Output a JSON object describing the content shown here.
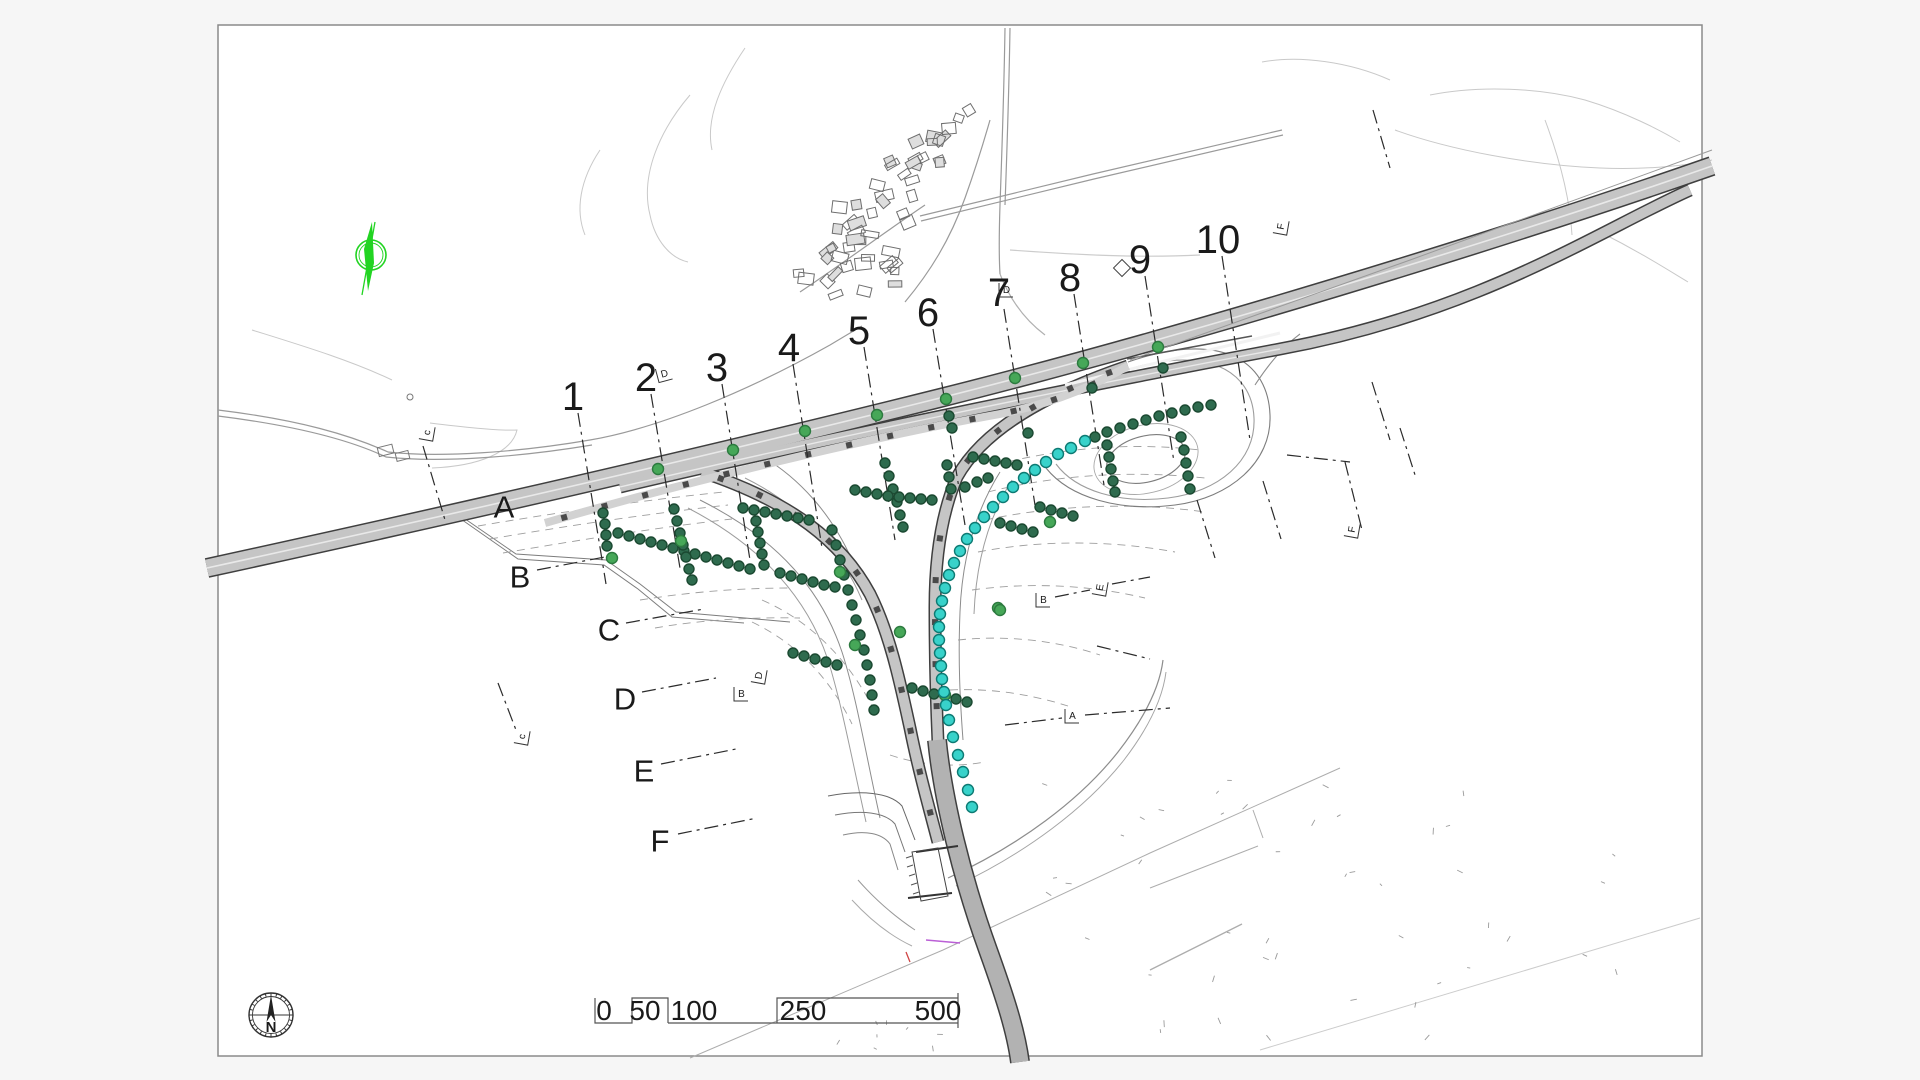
{
  "palette": {
    "background": "#f6f6f6",
    "paper": "#ffffff",
    "sheet_border": "#8a8a8a",
    "road_fill": "#c5c5c5",
    "road_fill_dark": "#b2b2b2",
    "road_casing": "#3f3f3f",
    "grid_line": "#2b2b2b",
    "dark_point_fill": "#2e6b4e",
    "dark_point_stroke": "#1b4931",
    "green_point_fill": "#46a758",
    "green_point_stroke": "#2c7a3f",
    "cyan_point_fill": "#38d2ca",
    "cyan_point_stroke": "#0d7a73",
    "north_symbol_green": "#22d422"
  },
  "compass": {
    "label": "N"
  },
  "scale_bar": {
    "labels": [
      "0",
      "50",
      "100",
      "250",
      "500"
    ]
  },
  "grid": {
    "columns": [
      {
        "label": "1",
        "lx": 573,
        "ly": 397,
        "x1": 578,
        "y1": 413,
        "x2": 606,
        "y2": 584
      },
      {
        "label": "2",
        "lx": 646,
        "ly": 378,
        "x1": 651,
        "y1": 394,
        "x2": 680,
        "y2": 568
      },
      {
        "label": "3",
        "lx": 717,
        "ly": 368,
        "x1": 722,
        "y1": 384,
        "x2": 750,
        "y2": 560
      },
      {
        "label": "4",
        "lx": 789,
        "ly": 348,
        "x1": 793,
        "y1": 364,
        "x2": 822,
        "y2": 548
      },
      {
        "label": "5",
        "lx": 859,
        "ly": 331,
        "x1": 864,
        "y1": 347,
        "x2": 895,
        "y2": 540
      },
      {
        "label": "6",
        "lx": 928,
        "ly": 313,
        "x1": 933,
        "y1": 329,
        "x2": 965,
        "y2": 525
      },
      {
        "label": "7",
        "lx": 999,
        "ly": 293,
        "x1": 1004,
        "y1": 309,
        "x2": 1035,
        "y2": 505
      },
      {
        "label": "8",
        "lx": 1070,
        "ly": 278,
        "x1": 1074,
        "y1": 294,
        "x2": 1104,
        "y2": 485
      },
      {
        "label": "9",
        "lx": 1140,
        "ly": 260,
        "x1": 1145,
        "y1": 276,
        "x2": 1174,
        "y2": 462
      },
      {
        "label": "10",
        "lx": 1218,
        "ly": 240,
        "x1": 1222,
        "y1": 256,
        "x2": 1250,
        "y2": 440
      }
    ],
    "rows": [
      {
        "label": "A",
        "lx": 504,
        "ly": 507
      },
      {
        "label": "B",
        "lx": 520,
        "ly": 577,
        "x1": 537,
        "y1": 570,
        "x2": 610,
        "y2": 556
      },
      {
        "label": "C",
        "lx": 609,
        "ly": 630,
        "x1": 626,
        "y1": 623,
        "x2": 704,
        "y2": 609
      },
      {
        "label": "D",
        "lx": 625,
        "ly": 699,
        "x1": 642,
        "y1": 692,
        "x2": 716,
        "y2": 678
      },
      {
        "label": "E",
        "lx": 644,
        "ly": 771,
        "x1": 661,
        "y1": 764,
        "x2": 736,
        "y2": 749
      },
      {
        "label": "F",
        "lx": 660,
        "ly": 841,
        "x1": 678,
        "y1": 834,
        "x2": 757,
        "y2": 818
      }
    ],
    "extra_segments": [
      [
        1197,
        500,
        1215,
        558
      ],
      [
        1263,
        481,
        1281,
        539
      ],
      [
        1287,
        455,
        1350,
        462
      ],
      [
        1345,
        462,
        1362,
        530
      ],
      [
        1055,
        597,
        1090,
        590
      ],
      [
        1112,
        584,
        1150,
        577
      ],
      [
        1005,
        725,
        1062,
        718
      ],
      [
        1085,
        715,
        1170,
        708
      ],
      [
        1097,
        646,
        1150,
        659
      ],
      [
        1372,
        382,
        1390,
        440
      ],
      [
        1400,
        428,
        1416,
        478
      ],
      [
        1373,
        110,
        1390,
        168
      ],
      [
        423,
        446,
        445,
        520
      ],
      [
        498,
        683,
        516,
        730
      ]
    ]
  },
  "section_flags": [
    {
      "x": 664,
      "y": 374,
      "t": "D",
      "r": -15
    },
    {
      "x": 427,
      "y": 433,
      "t": "c",
      "r": -80
    },
    {
      "x": 522,
      "y": 737,
      "t": "c",
      "r": -80
    },
    {
      "x": 759,
      "y": 676,
      "t": "D",
      "r": -80
    },
    {
      "x": 741,
      "y": 694,
      "t": "B",
      "r": 0
    },
    {
      "x": 1043,
      "y": 600,
      "t": "B",
      "r": 0
    },
    {
      "x": 1100,
      "y": 588,
      "t": "E",
      "r": -80
    },
    {
      "x": 1352,
      "y": 530,
      "t": "F",
      "r": -80
    },
    {
      "x": 1072,
      "y": 716,
      "t": "A",
      "r": 0
    },
    {
      "x": 1281,
      "y": 227,
      "t": "F",
      "r": -80
    },
    {
      "x": 1006,
      "y": 290,
      "t": "D",
      "r": 0
    }
  ],
  "diamond_marker": {
    "x": 1122,
    "y": 268
  },
  "points": {
    "dark": [
      [
        603,
        513
      ],
      [
        605,
        524
      ],
      [
        606,
        535
      ],
      [
        607,
        546
      ],
      [
        618,
        533
      ],
      [
        629,
        536
      ],
      [
        640,
        539
      ],
      [
        651,
        542
      ],
      [
        662,
        545
      ],
      [
        673,
        548
      ],
      [
        684,
        551
      ],
      [
        695,
        554
      ],
      [
        674,
        509
      ],
      [
        677,
        521
      ],
      [
        680,
        533
      ],
      [
        683,
        545
      ],
      [
        686,
        557
      ],
      [
        689,
        569
      ],
      [
        692,
        580
      ],
      [
        706,
        557
      ],
      [
        717,
        560
      ],
      [
        728,
        563
      ],
      [
        739,
        566
      ],
      [
        750,
        569
      ],
      [
        743,
        508
      ],
      [
        754,
        510
      ],
      [
        765,
        512
      ],
      [
        776,
        514
      ],
      [
        787,
        516
      ],
      [
        798,
        518
      ],
      [
        809,
        520
      ],
      [
        756,
        521
      ],
      [
        758,
        532
      ],
      [
        760,
        543
      ],
      [
        762,
        554
      ],
      [
        764,
        565
      ],
      [
        780,
        573
      ],
      [
        791,
        576
      ],
      [
        802,
        579
      ],
      [
        813,
        582
      ],
      [
        824,
        585
      ],
      [
        835,
        587
      ],
      [
        832,
        530
      ],
      [
        836,
        545
      ],
      [
        840,
        560
      ],
      [
        844,
        575
      ],
      [
        848,
        590
      ],
      [
        852,
        605
      ],
      [
        856,
        620
      ],
      [
        860,
        635
      ],
      [
        864,
        650
      ],
      [
        867,
        665
      ],
      [
        870,
        680
      ],
      [
        872,
        695
      ],
      [
        874,
        710
      ],
      [
        793,
        653
      ],
      [
        804,
        656
      ],
      [
        815,
        659
      ],
      [
        826,
        662
      ],
      [
        837,
        665
      ],
      [
        885,
        463
      ],
      [
        889,
        476
      ],
      [
        893,
        489
      ],
      [
        897,
        502
      ],
      [
        900,
        515
      ],
      [
        903,
        527
      ],
      [
        949,
        416
      ],
      [
        952,
        428
      ],
      [
        855,
        490
      ],
      [
        866,
        492
      ],
      [
        877,
        494
      ],
      [
        888,
        496
      ],
      [
        899,
        497
      ],
      [
        910,
        498
      ],
      [
        921,
        499
      ],
      [
        932,
        500
      ],
      [
        912,
        688
      ],
      [
        923,
        691
      ],
      [
        934,
        694
      ],
      [
        956,
        699
      ],
      [
        967,
        702
      ],
      [
        973,
        457
      ],
      [
        984,
        459
      ],
      [
        995,
        461
      ],
      [
        1006,
        463
      ],
      [
        1017,
        465
      ],
      [
        947,
        465
      ],
      [
        949,
        477
      ],
      [
        951,
        489
      ],
      [
        965,
        487
      ],
      [
        977,
        482
      ],
      [
        988,
        478
      ],
      [
        1000,
        523
      ],
      [
        1011,
        526
      ],
      [
        1022,
        529
      ],
      [
        1033,
        532
      ],
      [
        1040,
        507
      ],
      [
        1051,
        510
      ],
      [
        1062,
        513
      ],
      [
        1073,
        516
      ],
      [
        1095,
        437
      ],
      [
        1107,
        432
      ],
      [
        1120,
        428
      ],
      [
        1133,
        424
      ],
      [
        1146,
        420
      ],
      [
        1159,
        416
      ],
      [
        1172,
        413
      ],
      [
        1185,
        410
      ],
      [
        1198,
        407
      ],
      [
        1211,
        405
      ],
      [
        1107,
        445
      ],
      [
        1109,
        457
      ],
      [
        1111,
        469
      ],
      [
        1113,
        481
      ],
      [
        1115,
        492
      ],
      [
        1181,
        437
      ],
      [
        1184,
        450
      ],
      [
        1186,
        463
      ],
      [
        1188,
        476
      ],
      [
        1190,
        489
      ],
      [
        1163,
        368
      ],
      [
        1092,
        388
      ],
      [
        1028,
        433
      ]
    ],
    "green": [
      [
        658,
        469
      ],
      [
        733,
        450
      ],
      [
        805,
        431
      ],
      [
        877,
        415
      ],
      [
        946,
        399
      ],
      [
        1015,
        378
      ],
      [
        1083,
        363
      ],
      [
        1158,
        347
      ],
      [
        612,
        558
      ],
      [
        681,
        541
      ],
      [
        840,
        572
      ],
      [
        855,
        645
      ],
      [
        900,
        632
      ],
      [
        998,
        608
      ],
      [
        945,
        695
      ],
      [
        1050,
        522
      ],
      [
        1000,
        610
      ]
    ],
    "cyan": [
      [
        1085,
        441
      ],
      [
        1071,
        448
      ],
      [
        1058,
        454
      ],
      [
        1046,
        462
      ],
      [
        1035,
        470
      ],
      [
        1024,
        478
      ],
      [
        1013,
        487
      ],
      [
        1003,
        497
      ],
      [
        993,
        507
      ],
      [
        984,
        517
      ],
      [
        975,
        528
      ],
      [
        967,
        539
      ],
      [
        960,
        551
      ],
      [
        954,
        563
      ],
      [
        949,
        575
      ],
      [
        945,
        588
      ],
      [
        942,
        601
      ],
      [
        940,
        614
      ],
      [
        939,
        627
      ],
      [
        939,
        640
      ],
      [
        940,
        653
      ],
      [
        941,
        666
      ],
      [
        942,
        679
      ],
      [
        944,
        692
      ],
      [
        946,
        705
      ],
      [
        949,
        720
      ],
      [
        953,
        737
      ],
      [
        958,
        755
      ],
      [
        963,
        772
      ],
      [
        968,
        790
      ],
      [
        972,
        807
      ]
    ]
  },
  "village": {
    "building_count": 54
  }
}
